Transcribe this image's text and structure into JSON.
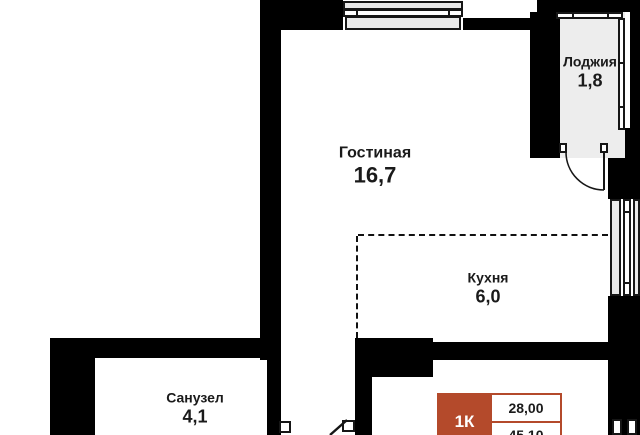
{
  "rooms": [
    {
      "name": "Гостиная",
      "area": "16,7"
    },
    {
      "name": "Лоджия",
      "area": "1,8"
    },
    {
      "name": "Кухня",
      "area": "6,0"
    },
    {
      "name": "Санузел",
      "area": "4,1"
    }
  ],
  "badge": {
    "type": "1К",
    "living_area": "28,00",
    "total_area": "45,10"
  },
  "colors": {
    "wall": "#000000",
    "window_fill": "#e9e9e9",
    "loggia_fill": "#ededed",
    "accent_red": "#b44a2b",
    "text": "#1a1a1a",
    "background": "#ffffff"
  }
}
